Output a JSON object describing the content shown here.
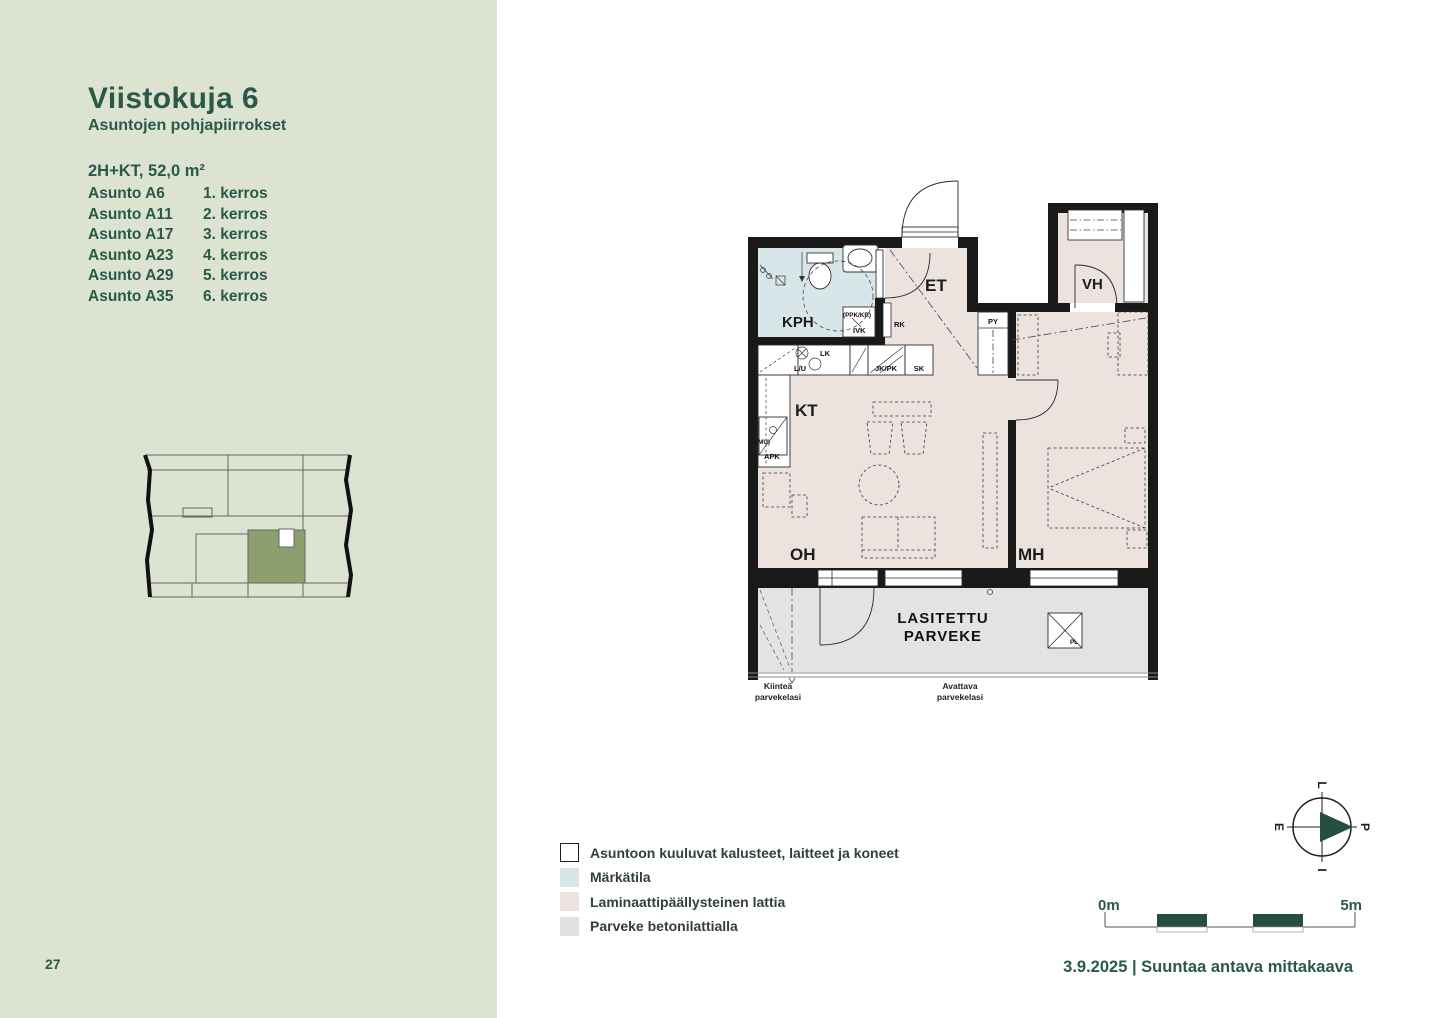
{
  "page": {
    "number": "27"
  },
  "sidebar": {
    "title": "Viistokuja 6",
    "subtitle": "Asuntojen pohjapiirrokset",
    "unit_type": "2H+KT, 52,0 m²",
    "apartments": [
      {
        "name": "Asunto A6",
        "floor": "1. kerros"
      },
      {
        "name": "Asunto A11",
        "floor": "2. kerros"
      },
      {
        "name": "Asunto A17",
        "floor": "3. kerros"
      },
      {
        "name": "Asunto A23",
        "floor": "4. kerros"
      },
      {
        "name": "Asunto A29",
        "floor": "5. kerros"
      },
      {
        "name": "Asunto A35",
        "floor": "6. kerros"
      }
    ]
  },
  "floorplan": {
    "rooms": {
      "kph": "KPH",
      "et": "ET",
      "vh": "VH",
      "kt": "KT",
      "oh": "OH",
      "mh": "MH"
    },
    "balcony_line1": "LASITETTU",
    "balcony_line2": "PARVEKE",
    "fixtures": {
      "ppk_kr": "(PPK/KR)",
      "ivk": "IVK",
      "rk": "RK",
      "py": "PY",
      "lk": "LK",
      "lu": "L/U",
      "jk_pk": "JK/PK",
      "sk": "SK",
      "mu": "(MU)",
      "apk": "APK",
      "pl": "PL"
    },
    "glass_fixed_line1": "Kiinteä",
    "glass_fixed_line2": "parvekelasi",
    "glass_open_line1": "Avattava",
    "glass_open_line2": "parvekelasi"
  },
  "legend": {
    "items": [
      {
        "label": "Asuntoon kuuluvat kalusteet, laitteet ja koneet",
        "swatch": "#ffffff"
      },
      {
        "label": "Märkätila",
        "swatch": "#d8e5e9"
      },
      {
        "label": "Laminaattipäällysteinen lattia",
        "swatch": "#ece3de"
      },
      {
        "label": "Parveke betonilattialla",
        "swatch": "#e1e1e0"
      }
    ]
  },
  "compass": {
    "top": "L",
    "right": "P",
    "bottom": "I",
    "left": "E"
  },
  "scalebar": {
    "start": "0m",
    "end": "5m"
  },
  "footer": {
    "date_scale_line": "3.9.2025 | Suuntaa antava mittakaava"
  },
  "colors": {
    "sidebar_bg": "#dde3d1",
    "accent_green": "#2a594a",
    "keyplan_highlight": "#8d9e70",
    "floor_laminate": "#ece3de",
    "wet_room": "#d8e5e9",
    "balcony_concrete": "#e3e3e2",
    "wall": "#191919",
    "scale_block": "#274f41"
  }
}
